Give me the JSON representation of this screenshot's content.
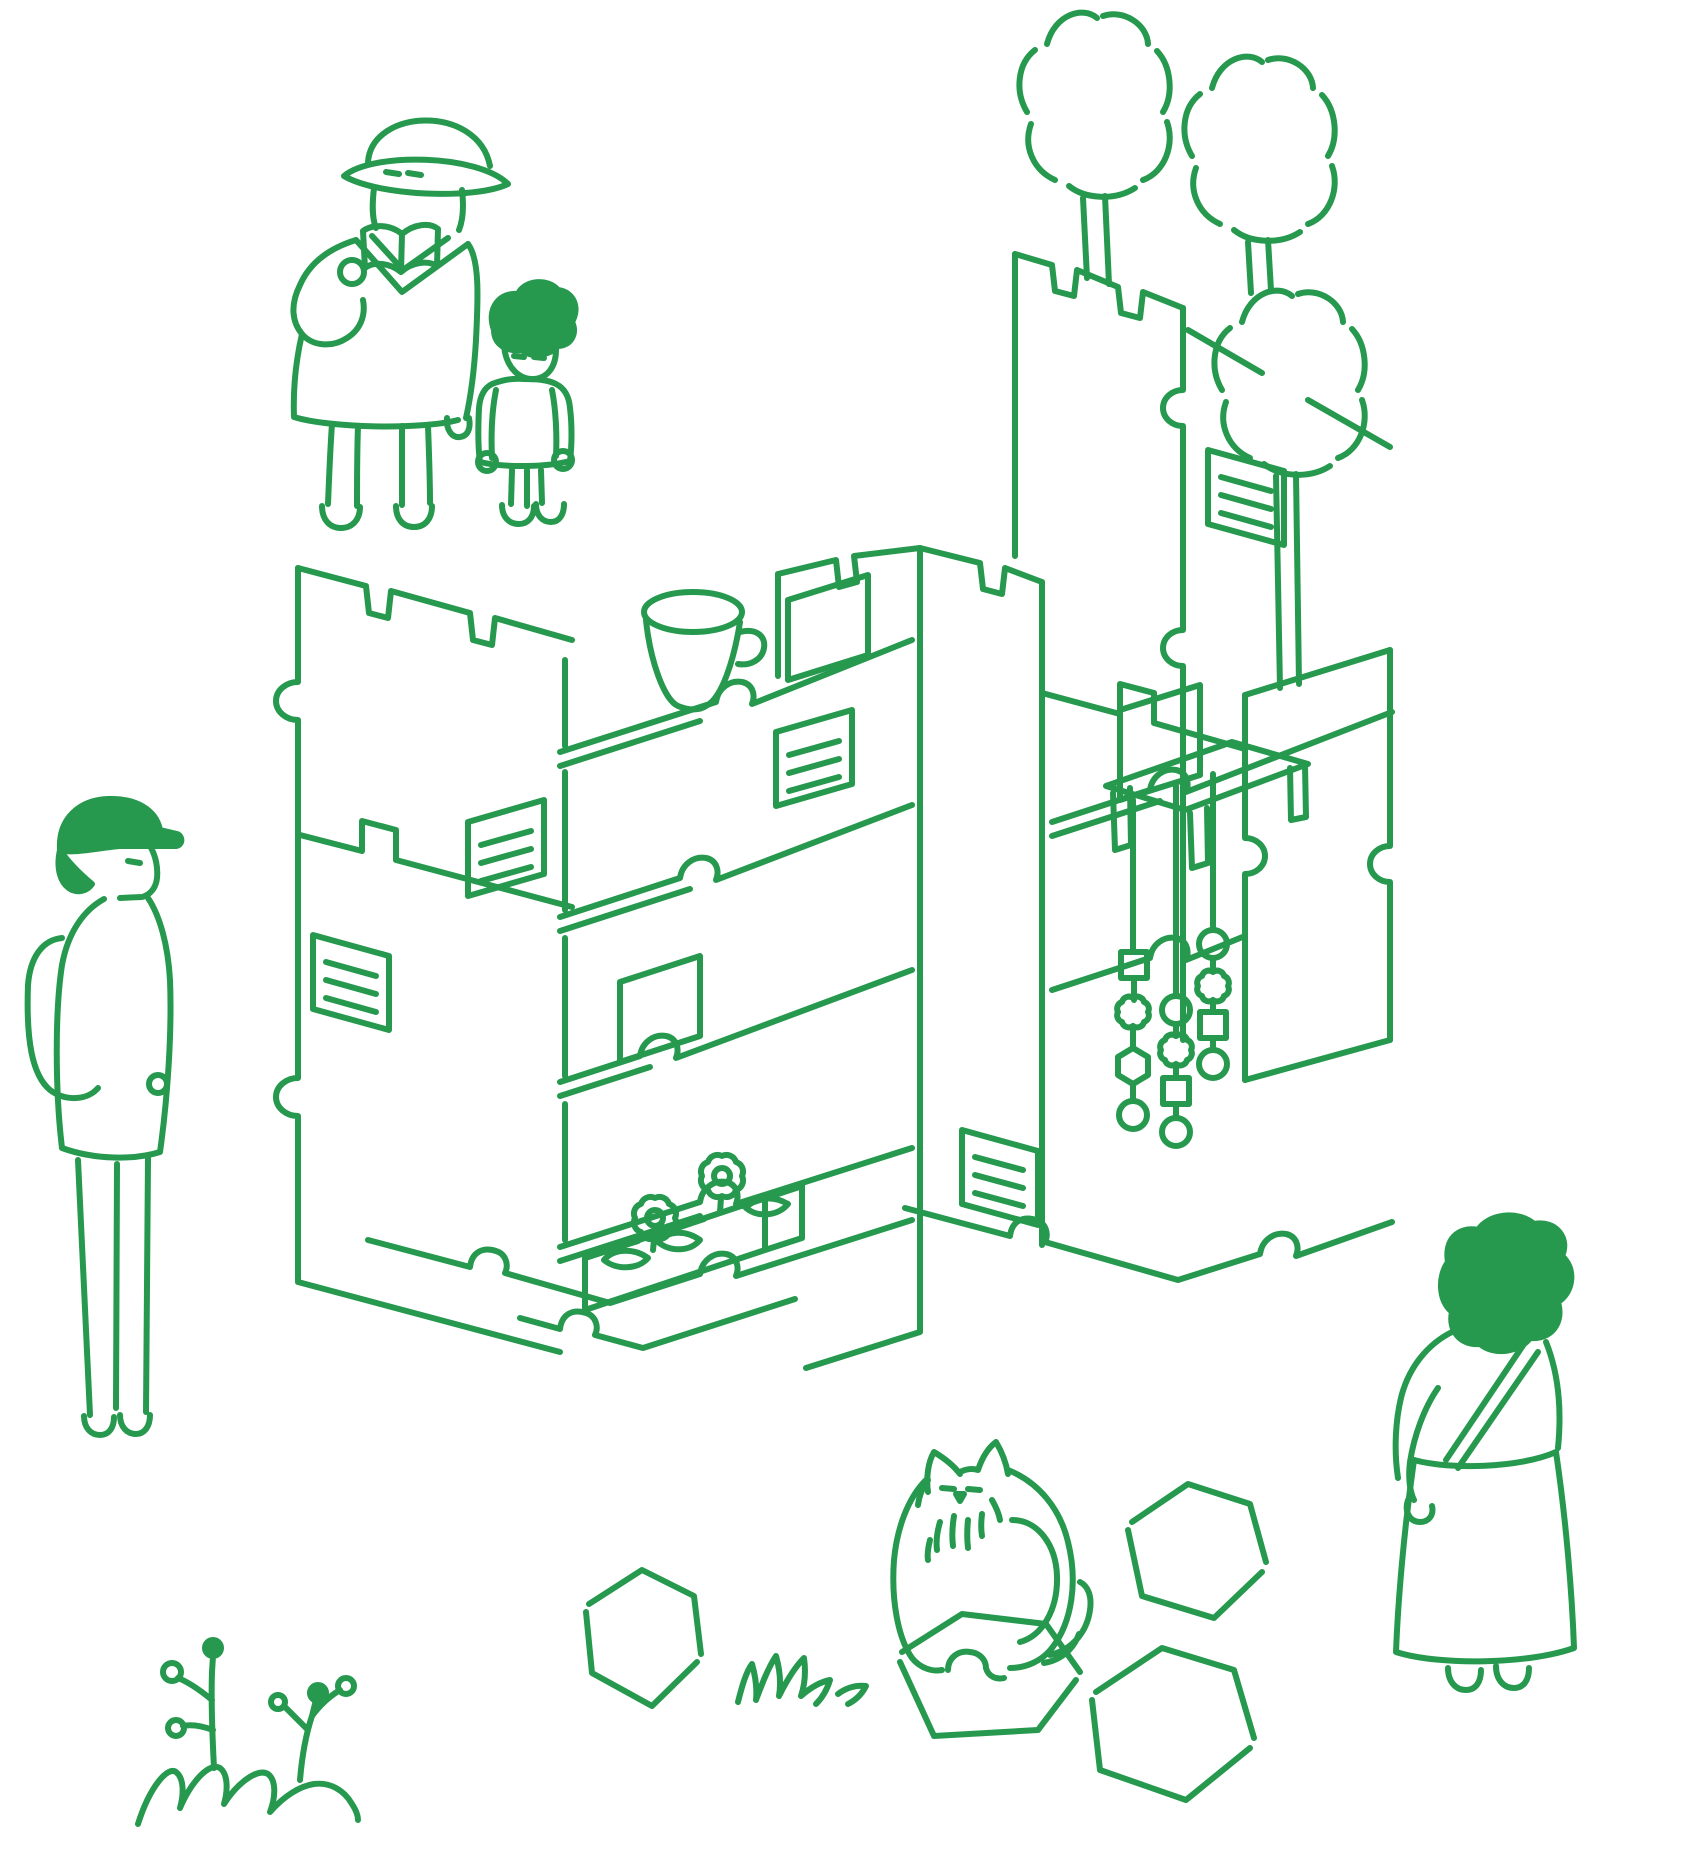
{
  "title": "Green line-art illustration: park scene with modular puzzle-panel shelf structure",
  "colors": {
    "ink": "#26994F",
    "background": "#FFFFFF"
  },
  "stroke": {
    "width_px": 6,
    "style": "hand-drawn, round caps"
  },
  "scene": {
    "figures": [
      {
        "id": "reading-adult",
        "label": "adult in bucket hat reading open book"
      },
      {
        "id": "child",
        "label": "child with green round hair standing beside adult"
      },
      {
        "id": "hiker",
        "label": "person with green cap and backpack, left side"
      },
      {
        "id": "woman",
        "label": "woman with green curly hair, shoulder bag, long skirt, lower right"
      }
    ],
    "animals": [
      {
        "id": "cat",
        "label": "fluffy cat sitting on hexagonal stone"
      }
    ],
    "vegetation": [
      {
        "id": "tree-1",
        "label": "cloud-shaped tree, top right"
      },
      {
        "id": "tree-2",
        "label": "cloud-shaped tree, upper far right"
      },
      {
        "id": "tree-3",
        "label": "cloud-shaped tree, right middle"
      },
      {
        "id": "sprout-plant",
        "label": "sprouting buds on mound, bottom left"
      },
      {
        "id": "grass-tuft",
        "label": "grass scribble near stones"
      }
    ],
    "structure": {
      "id": "puzzle-structure",
      "label": "isometric interlocking puzzle-piece panels forming shelves",
      "features": [
        "edge notches",
        "finger tabs",
        "S-shaped interlock tongues",
        "five pinned notes with line scribbles"
      ]
    },
    "props": [
      {
        "id": "cup",
        "label": "cup on top-left shelf"
      },
      {
        "id": "table",
        "label": "small low table on right shelf"
      },
      {
        "id": "mobiles",
        "label": "three hanging bead strings (squares, flowers, hexagons, circles)"
      },
      {
        "id": "planter",
        "label": "flower box with two gear-like flowers and leaves"
      }
    ],
    "ground": [
      {
        "id": "stone-left",
        "label": "hexagonal stepping stone"
      },
      {
        "id": "stone-cat",
        "label": "hexagonal stone under cat"
      },
      {
        "id": "stone-right-upper",
        "label": "hexagonal stepping stone"
      },
      {
        "id": "stone-right-lower",
        "label": "hexagonal stepping stone"
      }
    ]
  }
}
